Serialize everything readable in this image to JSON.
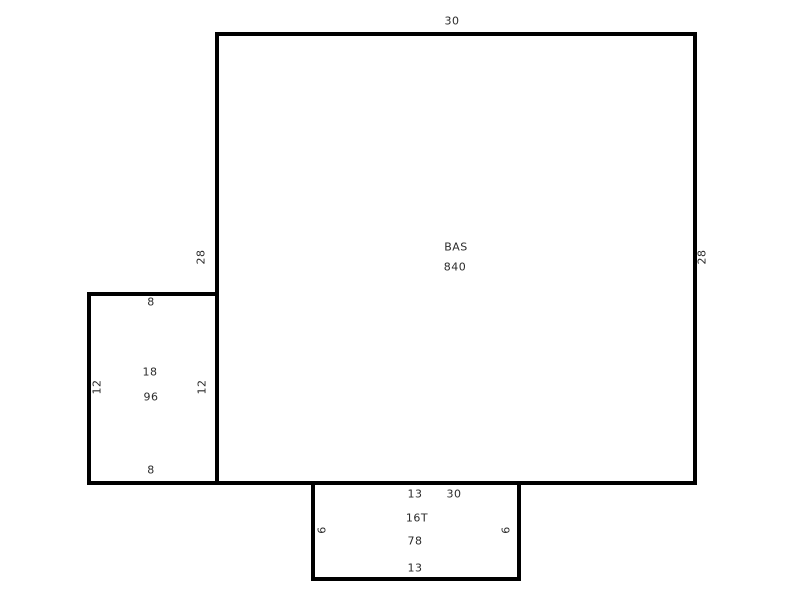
{
  "sketch": {
    "bas": {
      "code": "BAS",
      "area": "840",
      "dim_top": "30",
      "dim_left": "28",
      "dim_right": "28",
      "dim_bottom": "30"
    },
    "area18": {
      "code": "18",
      "area": "96",
      "dim_top": "8",
      "dim_left": "12",
      "dim_right": "12",
      "dim_bottom": "8"
    },
    "area16t": {
      "code": "16T",
      "area": "78",
      "dim_top": "13",
      "dim_left": "6",
      "dim_right": "6",
      "dim_bottom": "13"
    },
    "colors": {
      "line": "#000000",
      "text": "#2b2b2b",
      "background": "#ffffff"
    }
  }
}
